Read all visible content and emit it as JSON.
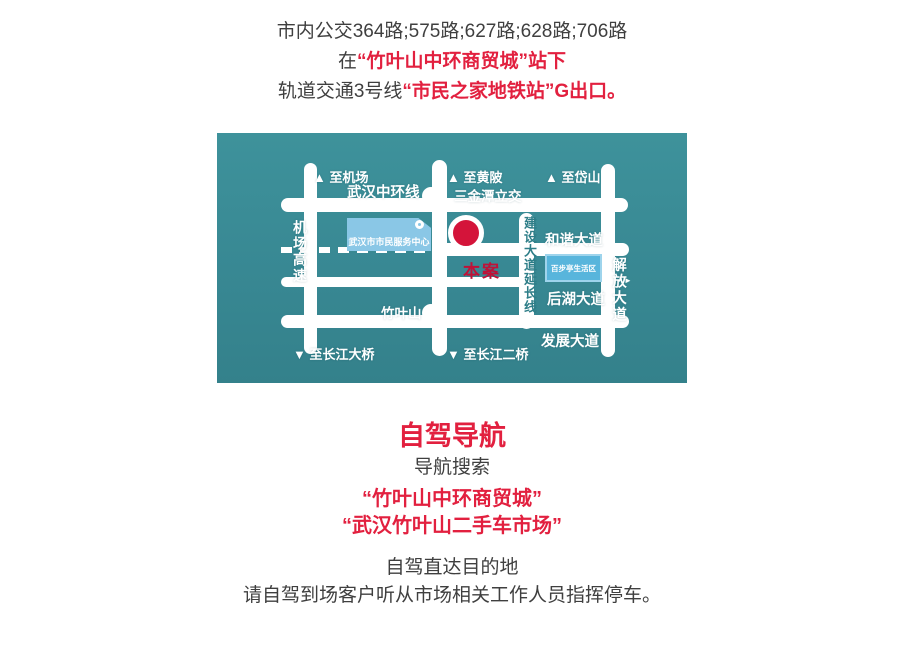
{
  "colors": {
    "accent_red": "#e2203f",
    "text_dark": "#3f3f3f",
    "map_teal": "#388893",
    "road_white": "#ffffff",
    "marker_red": "#d4143a",
    "building_blue": "#8ac7e6"
  },
  "transit": {
    "line1": "市内公交364路;575路;627路;628路;706路",
    "line2_prefix": "在",
    "line2_highlight": "“竹叶山中环商贸城”站下",
    "line3_prefix": "轨道交通3号线",
    "line3_highlight": "“市民之家地铁站”G出口。"
  },
  "map": {
    "labels": {
      "to_airport": "▲ 至机场",
      "zhonghuan_ring": "武汉中环线",
      "to_huangpi": "▲ 至黄陂",
      "sanjintan_interchange": "三金潭立交",
      "to_daishan": "▲ 至岱山",
      "airport_expressway": "机场高速",
      "citizen_center": "武汉市市民服务中心",
      "hexie_avenue": "和谐大道",
      "baibuting_block": "百步亭生活区",
      "jianshe_extension": "建设大道延长线",
      "jiefang_avenue": "解放大道",
      "jiefang_arrow": "►",
      "site_marker": "本案",
      "houhu_avenue": "后湖大道",
      "zhuyeshan": "竹叶山",
      "fazhan_avenue": "发展大道",
      "to_changjiang_bridge1": "▼ 至长江大桥",
      "to_changjiang_bridge2": "▼ 至长江二桥"
    }
  },
  "driving": {
    "title": "自驾导航",
    "subtitle": "导航搜索",
    "search1": "“竹叶山中环商贸城”",
    "search2": "“武汉竹叶山二手车市场”",
    "note1": "自驾直达目的地",
    "note2": "请自驾到场客户听从市场相关工作人员指挥停车。"
  }
}
